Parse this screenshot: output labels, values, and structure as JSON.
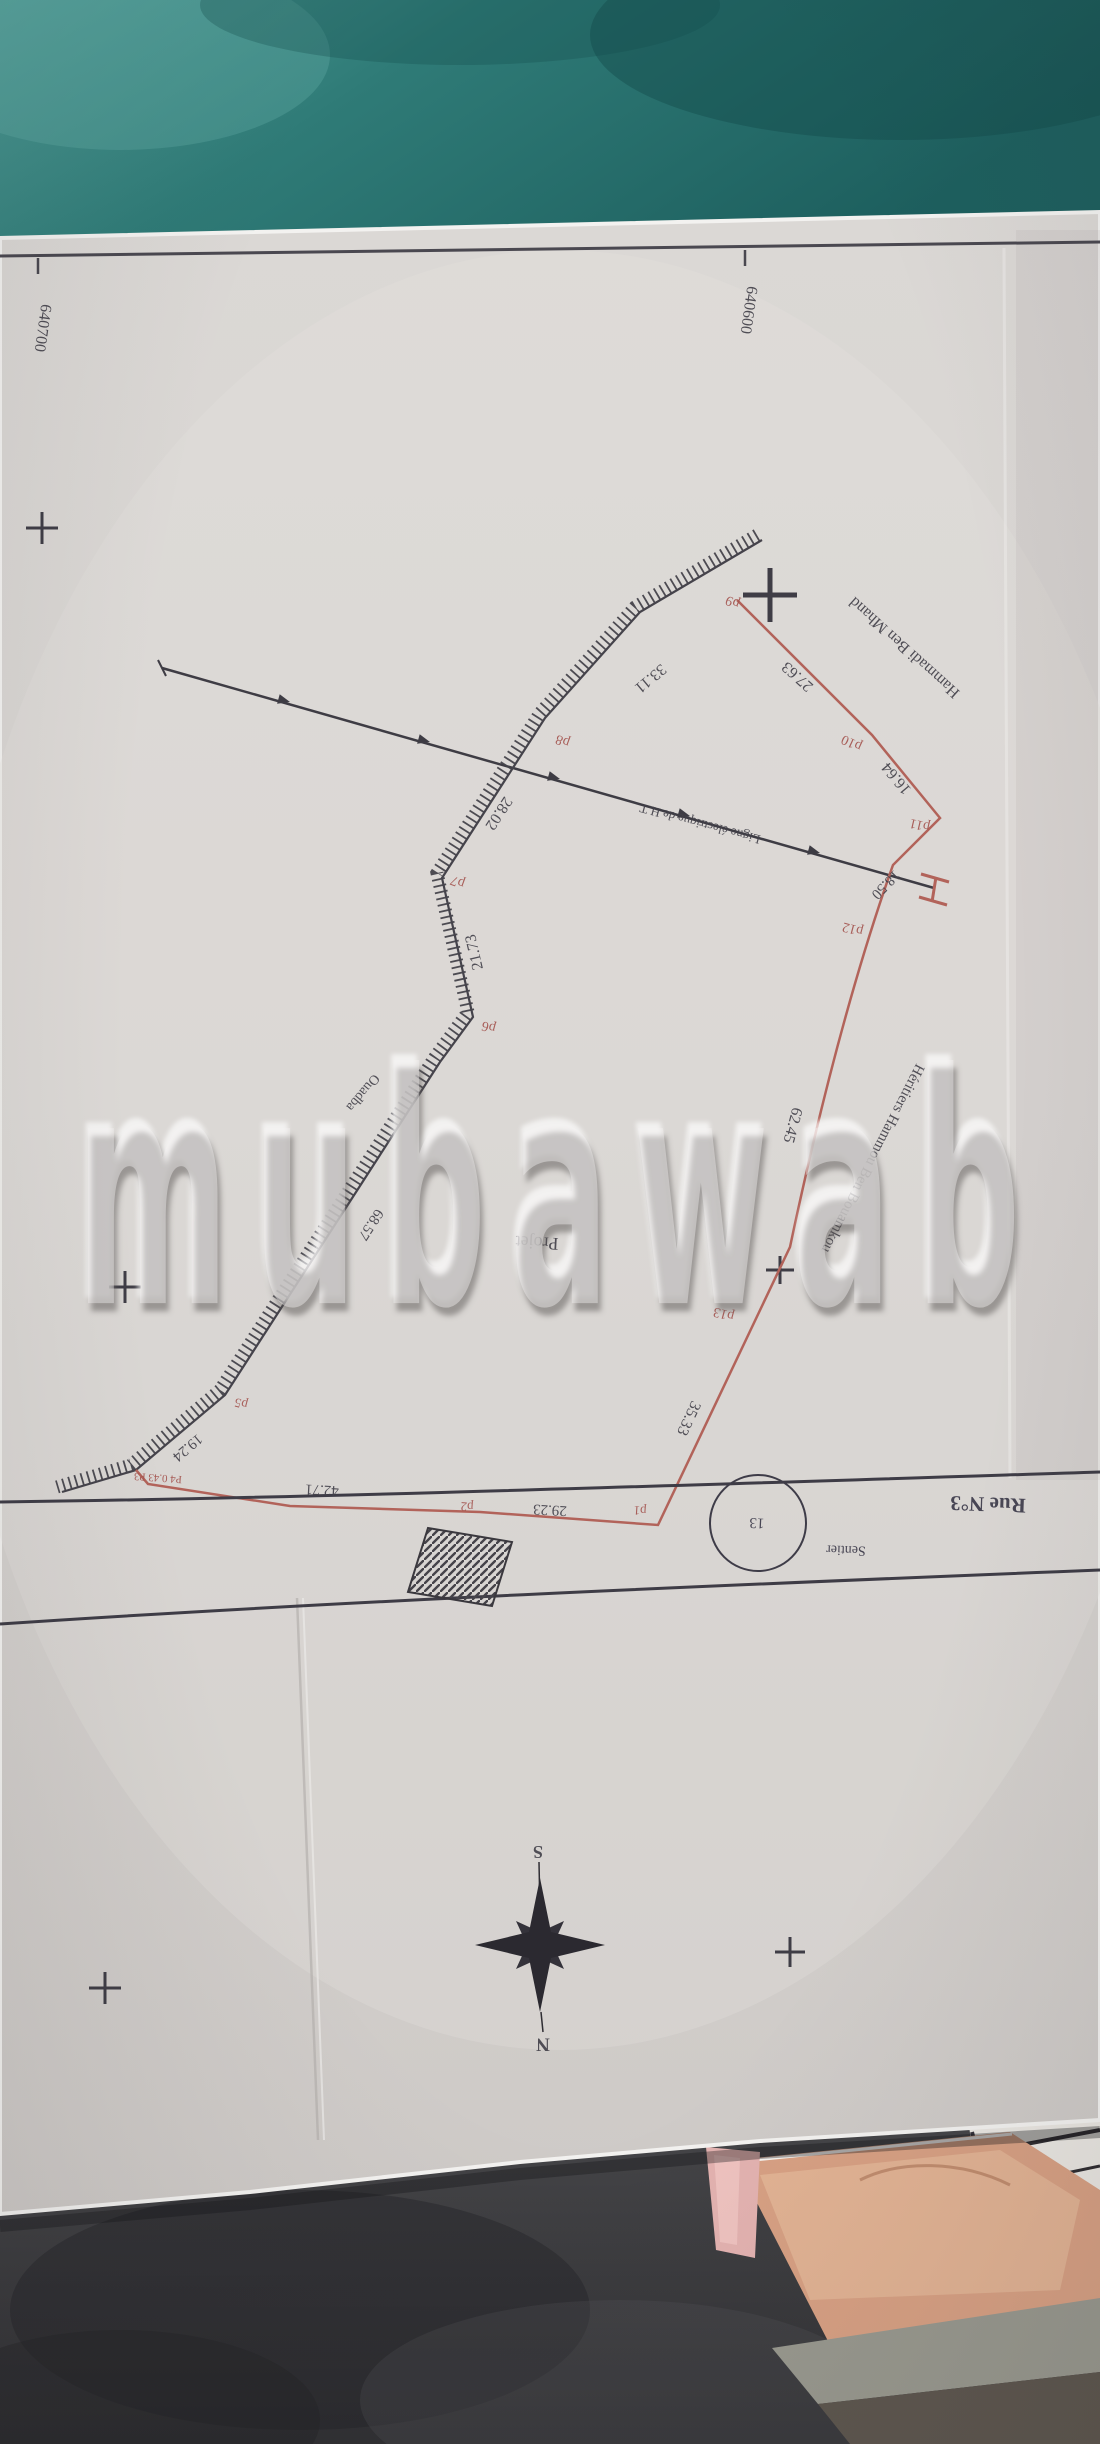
{
  "watermark": {
    "text": "mubawab"
  },
  "plan": {
    "summary": {
      "grid_coordinates": [
        "640700",
        "640600"
      ],
      "neighbour_names": [
        "Hammadi Ben Mhand",
        "Héritiers Hammou Ben Bouamkou"
      ],
      "road_name": "Rue N°3",
      "path_name": "Sentier",
      "path_number": "13",
      "project_label": "Projet",
      "place_label": "Ouadba",
      "power_line_label": "Ligne électrique de H.T",
      "compass": {
        "top": "S",
        "bottom": "N"
      },
      "boundary_points": [
        "p1",
        "p2",
        "p3",
        "p4",
        "p5",
        "p6",
        "p7",
        "p8",
        "p9",
        "p10",
        "p11",
        "p12",
        "p13"
      ],
      "sides": [
        {
          "from": "p1",
          "to": "p2",
          "length": "29.23"
        },
        {
          "from": "p2",
          "to": "p3",
          "length": "42.71"
        },
        {
          "from": "p3",
          "to": "p4",
          "length": "0.43"
        },
        {
          "from": "p4",
          "to": "p5",
          "length": "19.24"
        },
        {
          "from": "p5",
          "to": "p6",
          "length": "68.57"
        },
        {
          "from": "p6",
          "to": "p7",
          "length": "21.73"
        },
        {
          "from": "p7",
          "to": "p8",
          "length": "28.02"
        },
        {
          "from": "p8",
          "to": "p9",
          "length": "33.11"
        },
        {
          "from": "p9",
          "to": "p10",
          "length": "27.63"
        },
        {
          "from": "p10",
          "to": "p11",
          "length": "16.64"
        },
        {
          "from": "p11",
          "to": "p12",
          "length": "18.50"
        },
        {
          "from": "p12",
          "to": "p13",
          "length": "62.45"
        },
        {
          "from": "p13",
          "to": "p1",
          "length": "35.33"
        }
      ]
    },
    "labels": [
      {
        "name": "grid-coordinate-left",
        "text": "640700",
        "x": 42,
        "y": 328,
        "rot": 98,
        "size": 16,
        "color": "ink"
      },
      {
        "name": "grid-coordinate-right",
        "text": "640600",
        "x": 748,
        "y": 310,
        "rot": 98,
        "size": 16,
        "color": "ink"
      },
      {
        "name": "neighbour-name-north",
        "text": "Hammadi Ben Mhand",
        "x": 905,
        "y": 647,
        "rot": 222,
        "size": 16,
        "color": "ink"
      },
      {
        "name": "point-label-p9",
        "text": "p9",
        "x": 733,
        "y": 601,
        "rot": 202,
        "size": 14,
        "color": "red"
      },
      {
        "name": "distance-p9-p10",
        "text": "27.63",
        "x": 798,
        "y": 676,
        "rot": 222,
        "size": 16,
        "color": "ink"
      },
      {
        "name": "point-label-p10",
        "text": "p10",
        "x": 852,
        "y": 742,
        "rot": 205,
        "size": 14,
        "color": "red"
      },
      {
        "name": "distance-p10-p11",
        "text": "16.64",
        "x": 897,
        "y": 778,
        "rot": 230,
        "size": 16,
        "color": "ink"
      },
      {
        "name": "point-label-p11",
        "text": "p11",
        "x": 920,
        "y": 824,
        "rot": 193,
        "size": 14,
        "color": "red"
      },
      {
        "name": "distance-p11-p12",
        "text": "18.50",
        "x": 885,
        "y": 884,
        "rot": 134,
        "size": 15,
        "color": "ink"
      },
      {
        "name": "point-label-p12",
        "text": "p12",
        "x": 853,
        "y": 928,
        "rot": 195,
        "size": 14,
        "color": "red"
      },
      {
        "name": "distance-p12-p13",
        "text": "62.45",
        "x": 792,
        "y": 1125,
        "rot": 105,
        "size": 16,
        "color": "ink"
      },
      {
        "name": "neighbour-name-east",
        "text": "Héritiers Hammou Ben Bouamkou",
        "x": 872,
        "y": 1158,
        "rot": 117,
        "size": 15,
        "color": "ink"
      },
      {
        "name": "point-label-p13",
        "text": "p13",
        "x": 724,
        "y": 1313,
        "rot": 195,
        "size": 14,
        "color": "red"
      },
      {
        "name": "distance-p13-p1",
        "text": "35.33",
        "x": 688,
        "y": 1418,
        "rot": 115,
        "size": 16,
        "color": "ink"
      },
      {
        "name": "project-label",
        "text": "Projet",
        "x": 537,
        "y": 1243,
        "rot": 183,
        "size": 18,
        "color": "ink"
      },
      {
        "name": "place-label",
        "text": "Ouadba",
        "x": 362,
        "y": 1092,
        "rot": 130,
        "size": 14,
        "color": "ink"
      },
      {
        "name": "distance-p5-p6",
        "text": "68.57",
        "x": 370,
        "y": 1224,
        "rot": 123,
        "size": 15,
        "color": "ink"
      },
      {
        "name": "distance-p8-p9",
        "text": "33.11",
        "x": 650,
        "y": 678,
        "rot": 140,
        "size": 16,
        "color": "ink"
      },
      {
        "name": "point-label-p8",
        "text": "p8",
        "x": 563,
        "y": 740,
        "rot": 200,
        "size": 14,
        "color": "red"
      },
      {
        "name": "distance-p7-p8",
        "text": "28.02",
        "x": 498,
        "y": 813,
        "rot": 123,
        "size": 16,
        "color": "ink"
      },
      {
        "name": "point-label-p7",
        "text": "p7",
        "x": 458,
        "y": 881,
        "rot": 200,
        "size": 14,
        "color": "red"
      },
      {
        "name": "distance-p6-p7",
        "text": "21.73",
        "x": 475,
        "y": 952,
        "rot": 257,
        "size": 16,
        "color": "ink"
      },
      {
        "name": "point-label-p6",
        "text": "p6",
        "x": 489,
        "y": 1026,
        "rot": 195,
        "size": 14,
        "color": "red"
      },
      {
        "name": "distance-p4-p5",
        "text": "19.24",
        "x": 187,
        "y": 1447,
        "rot": 140,
        "size": 15,
        "color": "ink"
      },
      {
        "name": "point-label-p5",
        "text": "p5",
        "x": 241,
        "y": 1404,
        "rot": 195,
        "size": 13,
        "color": "red"
      },
      {
        "name": "points-p3-p4-jog",
        "text": "P4 0.43 P3",
        "x": 158,
        "y": 1477,
        "rot": 184,
        "size": 11,
        "color": "red"
      },
      {
        "name": "distance-p2-p3",
        "text": "42.71",
        "x": 322,
        "y": 1489,
        "rot": 183,
        "size": 15,
        "color": "ink"
      },
      {
        "name": "point-label-p2",
        "text": "p2",
        "x": 467,
        "y": 1507,
        "rot": 184,
        "size": 13,
        "color": "red"
      },
      {
        "name": "distance-p1-p2",
        "text": "29.23",
        "x": 550,
        "y": 1509,
        "rot": 183,
        "size": 15,
        "color": "ink"
      },
      {
        "name": "point-label-p1",
        "text": "p1",
        "x": 640,
        "y": 1511,
        "rot": 184,
        "size": 13,
        "color": "red"
      },
      {
        "name": "path-number",
        "text": "13",
        "x": 757,
        "y": 1522,
        "rot": 183,
        "size": 15,
        "color": "blue"
      },
      {
        "name": "path-name",
        "text": "Sentier",
        "x": 846,
        "y": 1549,
        "rot": 182,
        "size": 14,
        "color": "blue"
      },
      {
        "name": "road-name",
        "text": "Rue N°3",
        "x": 988,
        "y": 1504,
        "rot": 182,
        "size": 21,
        "color": "blue",
        "weight": "bold"
      },
      {
        "name": "power-line-label",
        "text": "Ligne électrique de H.T",
        "x": 700,
        "y": 824,
        "rot": 195,
        "size": 13,
        "color": "ink"
      },
      {
        "name": "compass-letter-s",
        "text": "S",
        "x": 538,
        "y": 1852,
        "rot": 180,
        "size": 18,
        "color": "ink",
        "weight": "bold"
      },
      {
        "name": "compass-letter-n",
        "text": "N",
        "x": 543,
        "y": 2044,
        "rot": 180,
        "size": 19,
        "color": "ink",
        "weight": "bold"
      }
    ]
  },
  "colors": {
    "paper": "#d8d4d1",
    "ink": "#44424b",
    "boundary_red": "#b2635a",
    "teal_background": "#2a7472",
    "carpet": "#3c3c3f",
    "peach_paper": "#d7a083",
    "pink_paper": "#e3b2b0"
  }
}
